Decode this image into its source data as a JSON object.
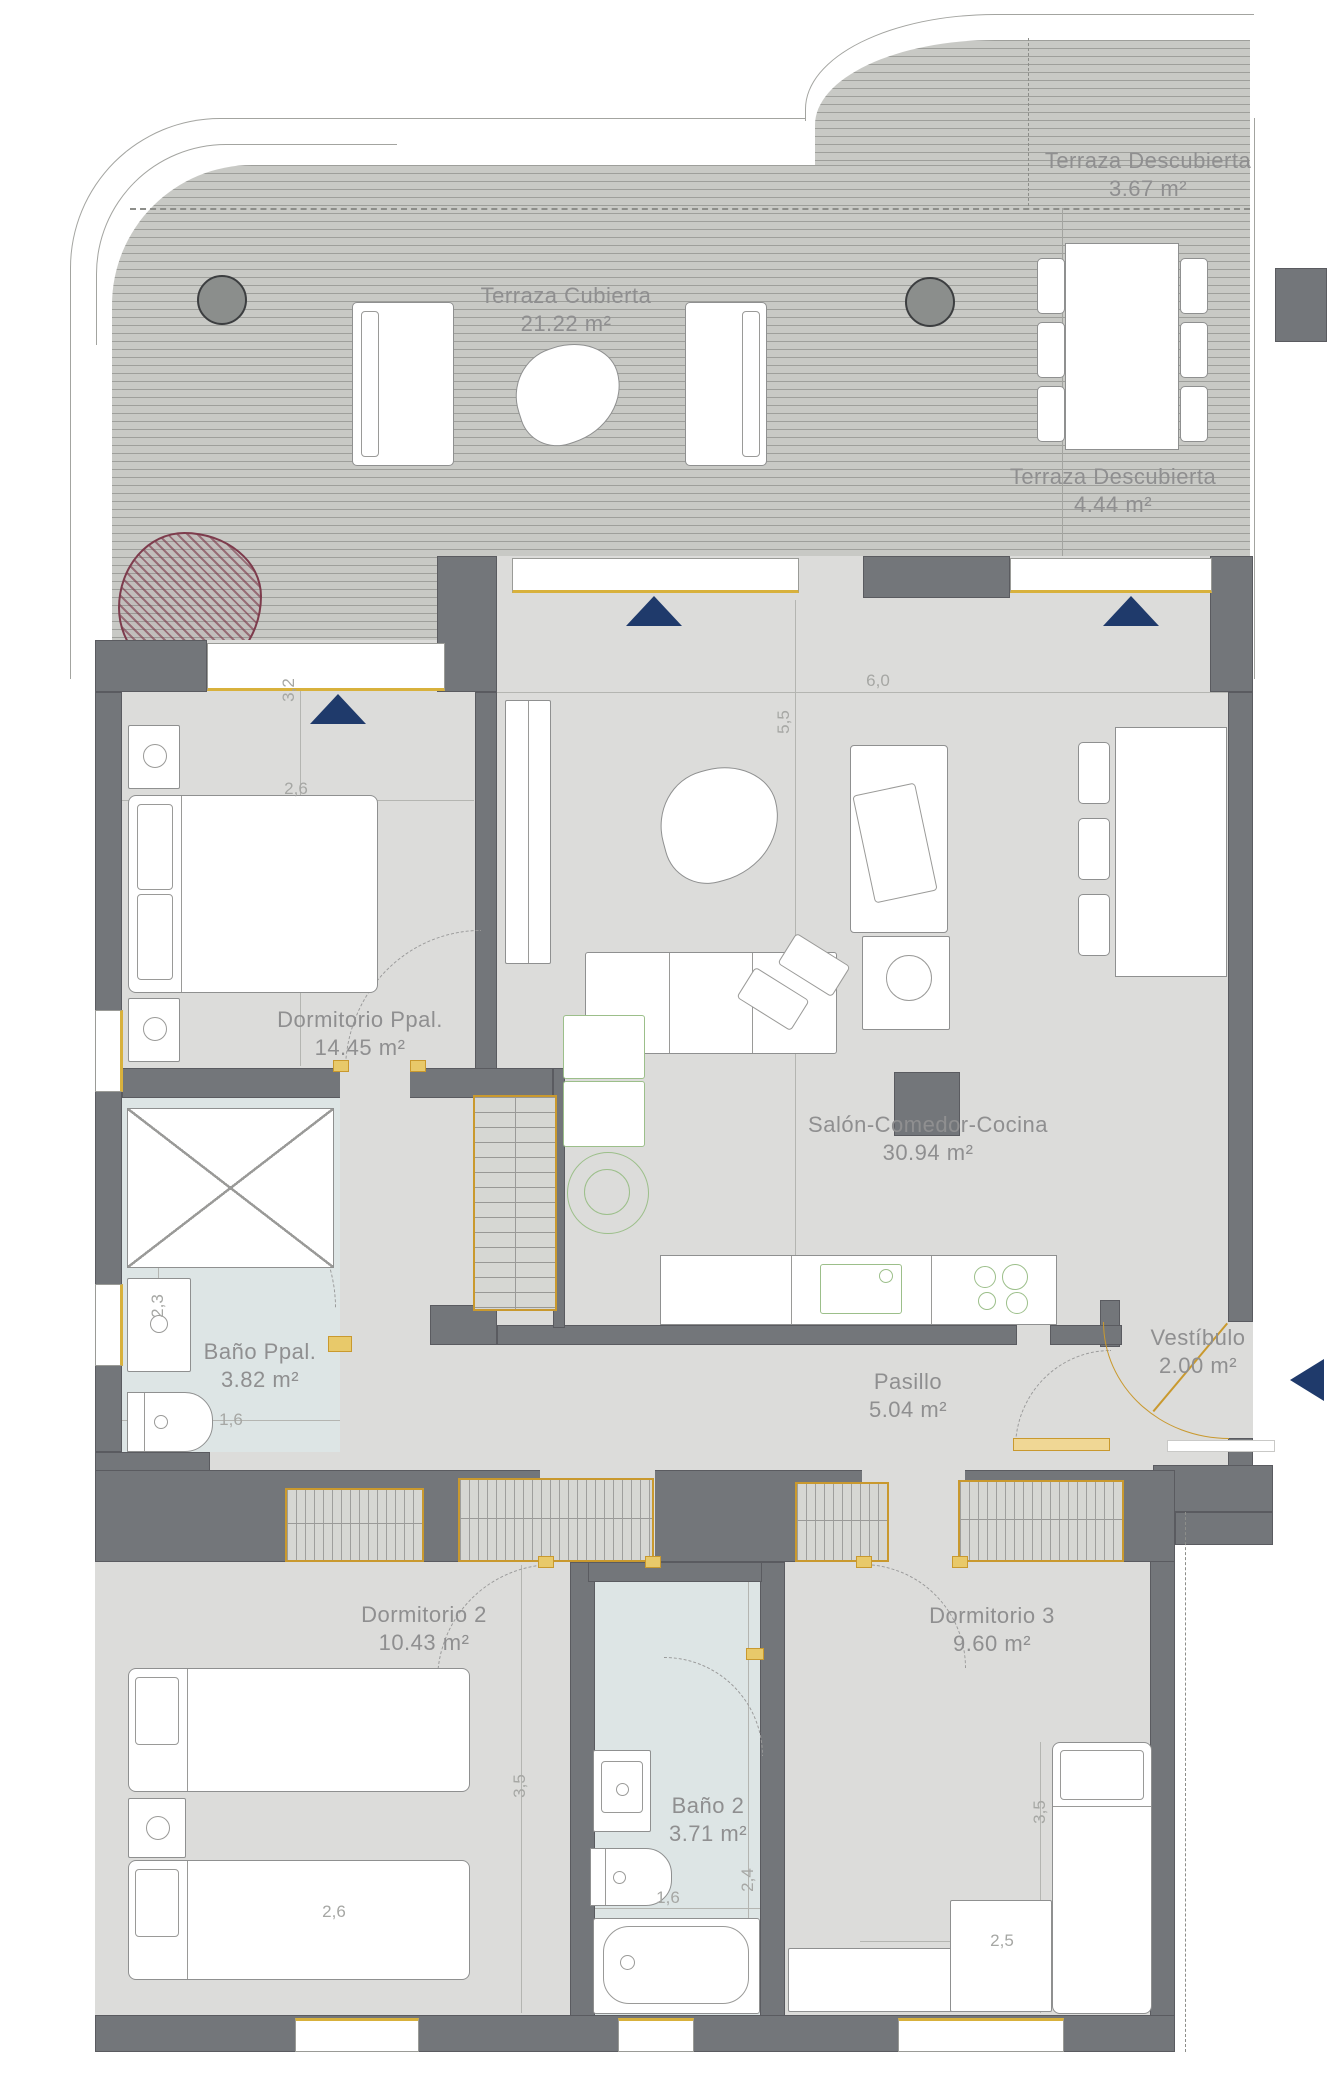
{
  "plan_title": "Apartment floor plan",
  "rooms": [
    {
      "name": "Terraza Descubierta",
      "area": "3.67 m²"
    },
    {
      "name": "Terraza Cubierta",
      "area": "21.22 m²"
    },
    {
      "name": "Terraza Descubierta",
      "area": "4.44 m²"
    },
    {
      "name": "Dormitorio Ppal.",
      "area": "14.45 m²"
    },
    {
      "name": "Salón-Comedor-Cocina",
      "area": "30.94 m²"
    },
    {
      "name": "Baño Ppal.",
      "area": "3.82 m²"
    },
    {
      "name": "Pasillo",
      "area": "5.04 m²"
    },
    {
      "name": "Vestíbulo",
      "area": "2.00 m²"
    },
    {
      "name": "Dormitorio 2",
      "area": "10.43 m²"
    },
    {
      "name": "Dormitorio 3",
      "area": "9.60 m²"
    },
    {
      "name": "Baño 2",
      "area": "3.71 m²"
    }
  ],
  "dimensions": [
    {
      "text": "2,6",
      "room": "Dormitorio Ppal."
    },
    {
      "text": "3,2",
      "room": "Dormitorio Ppal."
    },
    {
      "text": "6,0",
      "room": "Salón-Comedor-Cocina"
    },
    {
      "text": "5,5",
      "room": "Salón-Comedor-Cocina"
    },
    {
      "text": "2,3",
      "room": "Baño Ppal."
    },
    {
      "text": "1,6",
      "room": "Baño Ppal."
    },
    {
      "text": "3,5",
      "room": "Dormitorio 2"
    },
    {
      "text": "2,6",
      "room": "Dormitorio 2"
    },
    {
      "text": "1,6",
      "room": "Baño 2"
    },
    {
      "text": "2,4",
      "room": "Baño 2"
    },
    {
      "text": "3,5",
      "room": "Dormitorio 3"
    },
    {
      "text": "2,5",
      "room": "Dormitorio 3"
    }
  ],
  "markers": {
    "window_orientation_triangles": 3,
    "entrance_arrow": "left",
    "structural_columns": 2,
    "tree": 1
  },
  "colors": {
    "wall": "#73767a",
    "floor": "#dcdcda",
    "terrace": "#c8c9c5",
    "bathroom": "#dde5e5",
    "door_gold": "#c9992e",
    "appliance_green": "#9cbf8a",
    "marker_navy": "#1f3a6b",
    "tree_maroon": "#7d3b4c",
    "label_gray": "#8f8f90"
  }
}
